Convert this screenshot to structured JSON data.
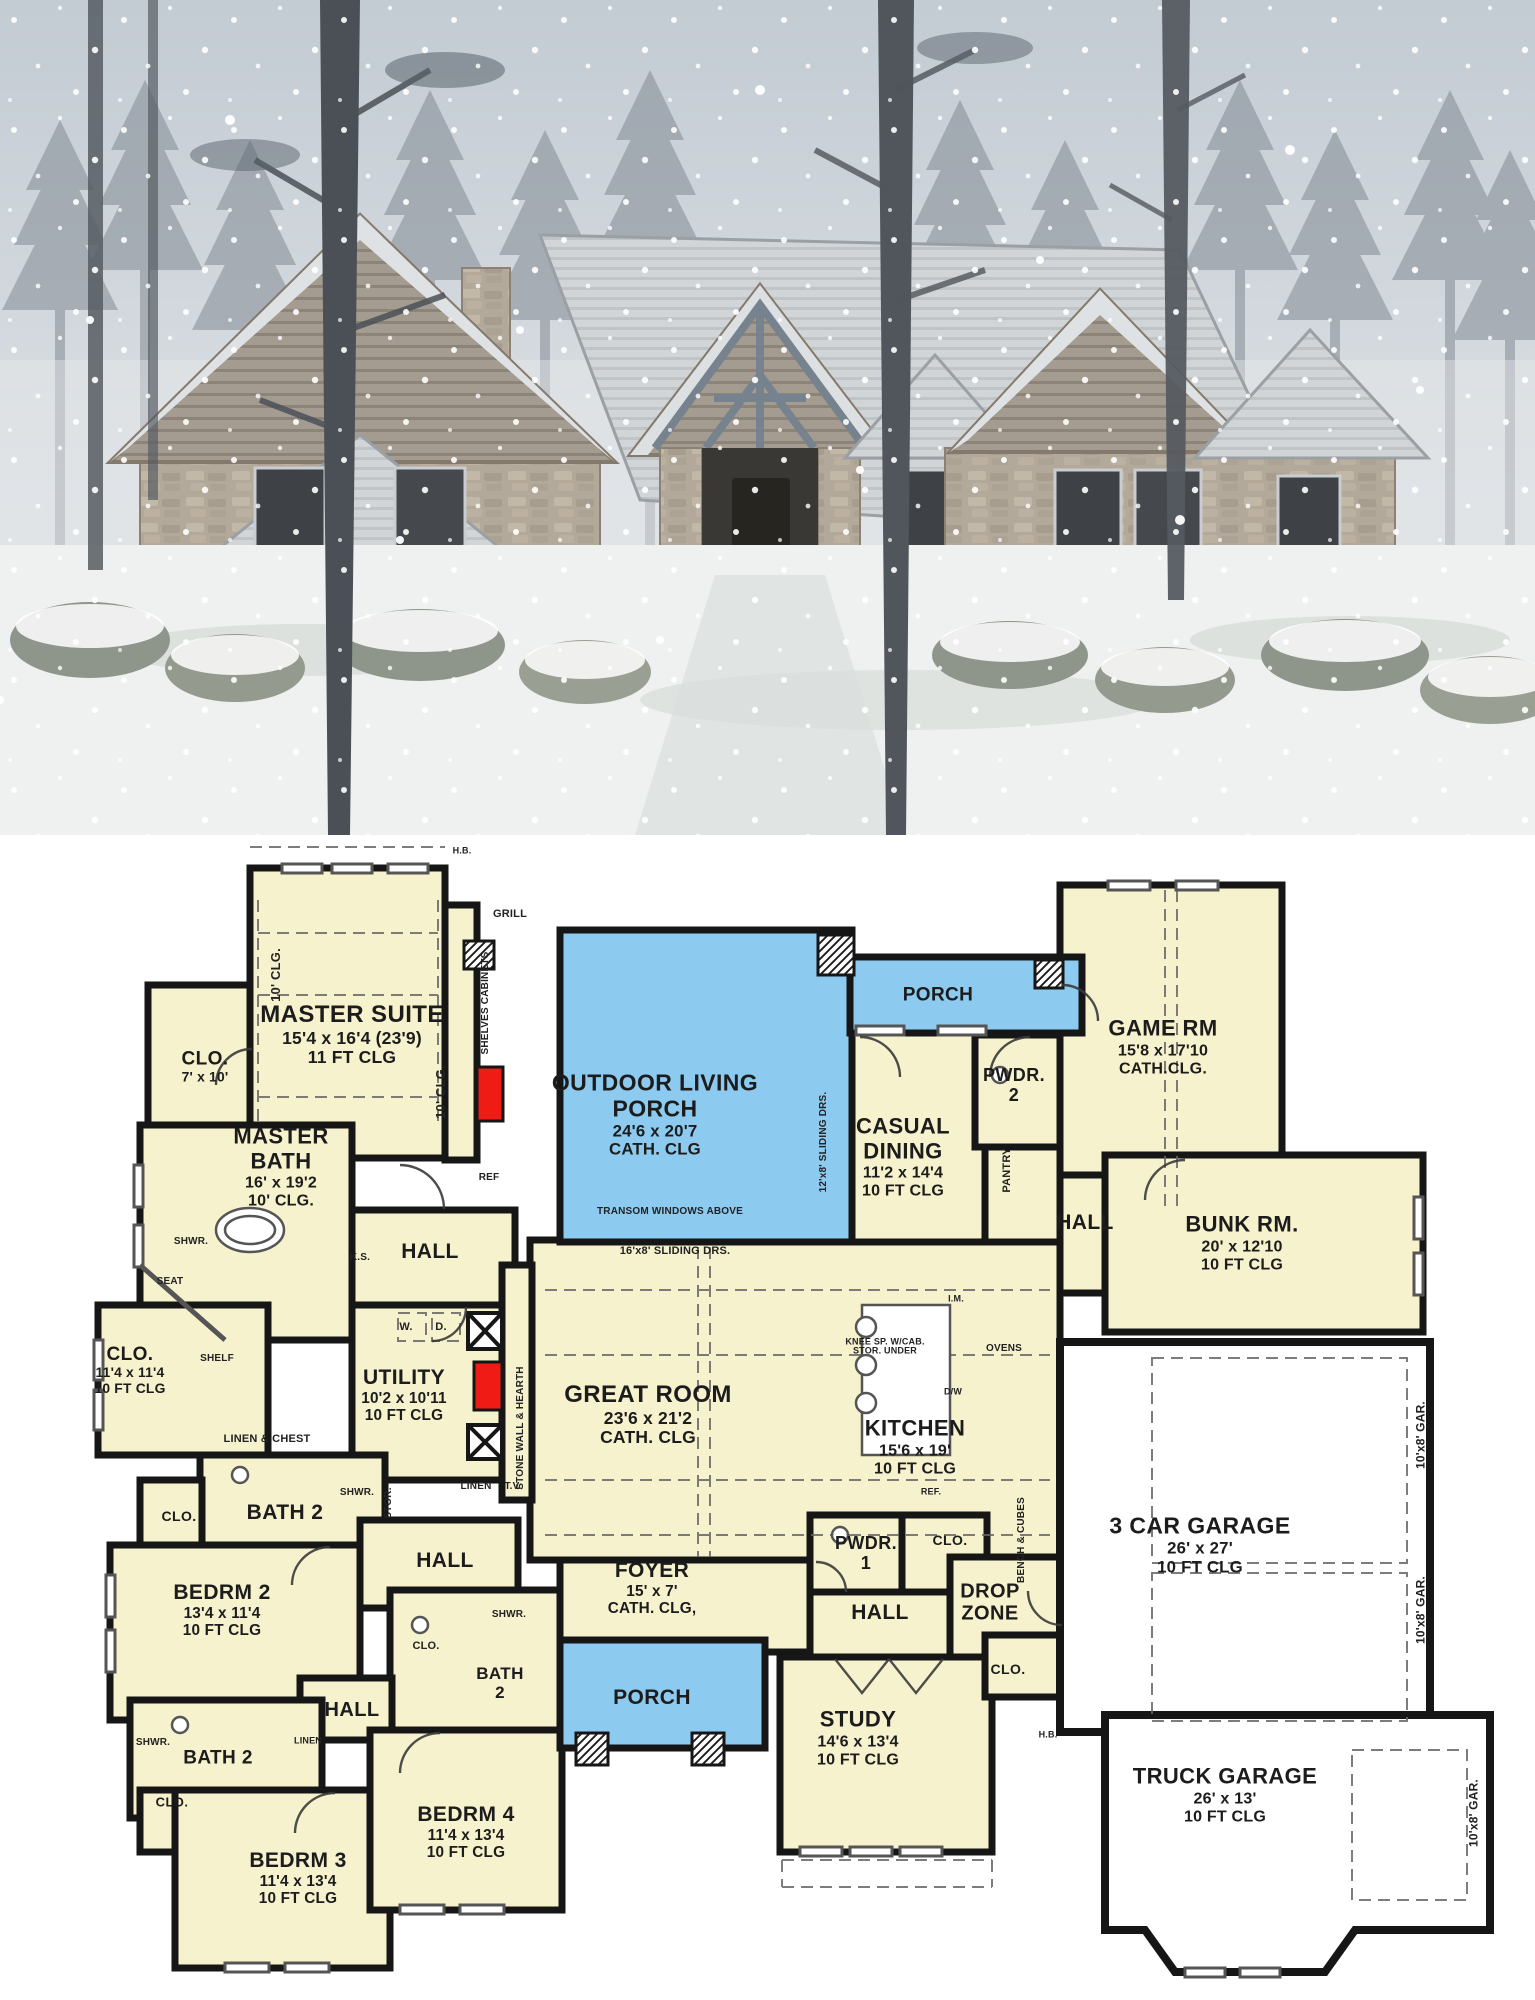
{
  "photo": {
    "description": "Snow-covered single-story stone ranch house with multiple gables and timber entry truss, surrounded by tall pine trees in falling snow"
  },
  "plan": {
    "colors": {
      "room_fill": "#f6f2cd",
      "porch_fill": "#8ccaf0",
      "garage_fill": "#ffffff",
      "wall": "#161616",
      "accent_red": "#ee1c14",
      "label_text": "#1c1c1c"
    },
    "rooms": [
      {
        "name": "MASTER SUITE",
        "dims": "15'4 x 16'4 (23'9)",
        "clg": "11 FT CLG",
        "x": 352,
        "y": 200,
        "size": 24
      },
      {
        "name": "CLO.",
        "dims": "7' x 10'",
        "x": 205,
        "y": 232,
        "size": 19
      },
      {
        "name": "MASTER BATH",
        "dims": "16' x 19'2",
        "clg": "10' CLG.",
        "x": 281,
        "y": 332,
        "size": 22,
        "w": 120
      },
      {
        "name": "OUTDOOR LIVING PORCH",
        "dims": "24'6 x 20'7",
        "clg": "CATH. CLG",
        "x": 655,
        "y": 280,
        "size": 23,
        "w": 215
      },
      {
        "name": "PORCH",
        "x": 938,
        "y": 160,
        "size": 19
      },
      {
        "name": "CASUAL DINING",
        "dims": "11'2 x 14'4",
        "clg": "10 FT CLG",
        "x": 903,
        "y": 322,
        "size": 22,
        "w": 130
      },
      {
        "name": "PWDR. 2",
        "x": 1014,
        "y": 250,
        "size": 18,
        "w": 72
      },
      {
        "name": "GAME RM",
        "dims": "15'8 x 17'10",
        "clg": "CATH.CLG.",
        "x": 1163,
        "y": 212,
        "size": 22
      },
      {
        "name": "BUNK RM.",
        "dims": "20' x 12'10",
        "clg": "10 FT CLG",
        "x": 1242,
        "y": 408,
        "size": 22
      },
      {
        "name": "HALL",
        "x": 1085,
        "y": 388,
        "size": 21
      },
      {
        "name": "GREAT ROOM",
        "dims": "23'6 x 21'2",
        "clg": "CATH. CLG",
        "x": 648,
        "y": 580,
        "size": 24
      },
      {
        "name": "KITCHEN",
        "dims": "15'6 x 19'",
        "clg": "10 FT CLG",
        "x": 915,
        "y": 612,
        "size": 22
      },
      {
        "name": "UTILITY",
        "dims": "10'2 x 10'11",
        "clg": "10 FT CLG",
        "x": 404,
        "y": 560,
        "size": 21
      },
      {
        "name": "CLO.",
        "dims": "11'4 x 11'4",
        "clg": "10 FT CLG",
        "x": 130,
        "y": 535,
        "size": 19
      },
      {
        "name": "BATH 2",
        "x": 285,
        "y": 678,
        "size": 21
      },
      {
        "name": "CLO.",
        "x": 179,
        "y": 682,
        "size": 14
      },
      {
        "name": "HALL",
        "x": 445,
        "y": 726,
        "size": 21
      },
      {
        "name": "BEDRM 2",
        "dims": "13'4 x 11'4",
        "clg": "10 FT CLG",
        "x": 222,
        "y": 775,
        "size": 21
      },
      {
        "name": "HALL",
        "x": 430,
        "y": 417,
        "size": 21
      },
      {
        "name": "FOYER",
        "dims": "15' x 7'",
        "clg": "CATH. CLG,",
        "x": 652,
        "y": 753,
        "size": 21
      },
      {
        "name": "PWDR. 1",
        "x": 866,
        "y": 718,
        "size": 18,
        "w": 72
      },
      {
        "name": "CLO.",
        "x": 950,
        "y": 706,
        "size": 14
      },
      {
        "name": "HALL",
        "x": 880,
        "y": 778,
        "size": 21
      },
      {
        "name": "DROP ZONE",
        "x": 990,
        "y": 768,
        "size": 20,
        "w": 85
      },
      {
        "name": "3 CAR GARAGE",
        "dims": "26' x 27'",
        "clg": "10 FT CLG",
        "x": 1200,
        "y": 710,
        "size": 23
      },
      {
        "name": "STUDY",
        "dims": "14'6 x 13'4",
        "clg": "10 FT CLG",
        "x": 858,
        "y": 903,
        "size": 22
      },
      {
        "name": "PORCH",
        "x": 652,
        "y": 863,
        "size": 21
      },
      {
        "name": "CLO.",
        "x": 1008,
        "y": 835,
        "size": 14
      },
      {
        "name": "BEDRM 4",
        "dims": "11'4 x 13'4",
        "clg": "10 FT CLG",
        "x": 466,
        "y": 997,
        "size": 21
      },
      {
        "name": "BEDRM 3",
        "dims": "11'4 x 13'4",
        "clg": "10 FT CLG",
        "x": 298,
        "y": 1043,
        "size": 21
      },
      {
        "name": "BATH 2",
        "x": 218,
        "y": 923,
        "size": 19
      },
      {
        "name": "CLO.",
        "x": 172,
        "y": 968,
        "size": 13
      },
      {
        "name": "TRUCK GARAGE",
        "dims": "26' x 13'",
        "clg": "10 FT CLG",
        "x": 1225,
        "y": 960,
        "size": 22
      },
      {
        "name": "BATH 2",
        "x": 500,
        "y": 848,
        "size": 17,
        "w": 58
      },
      {
        "name": "HALL",
        "x": 352,
        "y": 875,
        "size": 20
      }
    ],
    "labels": [
      {
        "text": "GRILL",
        "x": 510,
        "y": 80,
        "size": 11
      },
      {
        "text": "SHELVES CABINETS",
        "x": 486,
        "y": 168,
        "rot": -90,
        "size": 10
      },
      {
        "text": "REF",
        "x": 489,
        "y": 343,
        "size": 10
      },
      {
        "text": "K.S.",
        "x": 360,
        "y": 423,
        "size": 10
      },
      {
        "text": "W.",
        "x": 406,
        "y": 493,
        "size": 11
      },
      {
        "text": "D.",
        "x": 441,
        "y": 493,
        "size": 11
      },
      {
        "text": "SHELF",
        "x": 217,
        "y": 524,
        "size": 10
      },
      {
        "text": "SHWR.",
        "x": 191,
        "y": 407,
        "size": 10
      },
      {
        "text": "SEAT",
        "x": 170,
        "y": 447,
        "size": 10
      },
      {
        "text": "LINEN & CHEST",
        "x": 267,
        "y": 605,
        "size": 11
      },
      {
        "text": "STOR.",
        "x": 389,
        "y": 668,
        "rot": -90,
        "size": 10
      },
      {
        "text": "SHWR.",
        "x": 357,
        "y": 658,
        "size": 10
      },
      {
        "text": "LINEN",
        "x": 476,
        "y": 652,
        "size": 10
      },
      {
        "text": "T.V.",
        "x": 513,
        "y": 652,
        "size": 10
      },
      {
        "text": "STONE WALL & HEARTH",
        "x": 521,
        "y": 593,
        "rot": -90,
        "size": 10
      },
      {
        "text": "TRANSOM WINDOWS ABOVE",
        "x": 670,
        "y": 377,
        "size": 10
      },
      {
        "text": "16'x8' SLIDING DRS.",
        "x": 675,
        "y": 417,
        "size": 11
      },
      {
        "text": "12'x8' SLIDING DRS.",
        "x": 824,
        "y": 307,
        "rot": -90,
        "size": 10
      },
      {
        "text": "PANTRY",
        "x": 1008,
        "y": 335,
        "rot": -90,
        "size": 11
      },
      {
        "text": "KNEE SP. W/CAB. STOR. UNDER",
        "x": 885,
        "y": 512,
        "size": 9,
        "w": 85
      },
      {
        "text": "I.M.",
        "x": 956,
        "y": 464,
        "size": 9
      },
      {
        "text": "OVENS",
        "x": 1004,
        "y": 514,
        "size": 10
      },
      {
        "text": "D/W",
        "x": 953,
        "y": 557,
        "size": 9
      },
      {
        "text": "REF.",
        "x": 931,
        "y": 657,
        "size": 9
      },
      {
        "text": "BENCH & CUBES",
        "x": 1022,
        "y": 705,
        "rot": -90,
        "size": 10
      },
      {
        "text": "10'x8' GAR.",
        "x": 1421,
        "y": 600,
        "rot": -90,
        "size": 12
      },
      {
        "text": "10'x8' GAR.",
        "x": 1421,
        "y": 775,
        "rot": -90,
        "size": 12
      },
      {
        "text": "10'x8' GAR.",
        "x": 1474,
        "y": 978,
        "rot": -90,
        "size": 12
      },
      {
        "text": "H.B.",
        "x": 462,
        "y": 16,
        "size": 9
      },
      {
        "text": "H.B.",
        "x": 1048,
        "y": 900,
        "size": 9
      },
      {
        "text": "SHWR.",
        "x": 153,
        "y": 908,
        "size": 10
      },
      {
        "text": "LINEN",
        "x": 308,
        "y": 906,
        "size": 9
      },
      {
        "text": "SHWR.",
        "x": 509,
        "y": 780,
        "size": 10
      },
      {
        "text": "CLO.",
        "x": 426,
        "y": 812,
        "size": 11
      },
      {
        "text": "10' CLG.",
        "x": 276,
        "y": 140,
        "rot": -90,
        "size": 13
      },
      {
        "text": "10' CLG.",
        "x": 441,
        "y": 257,
        "rot": -90,
        "size": 13
      }
    ]
  }
}
